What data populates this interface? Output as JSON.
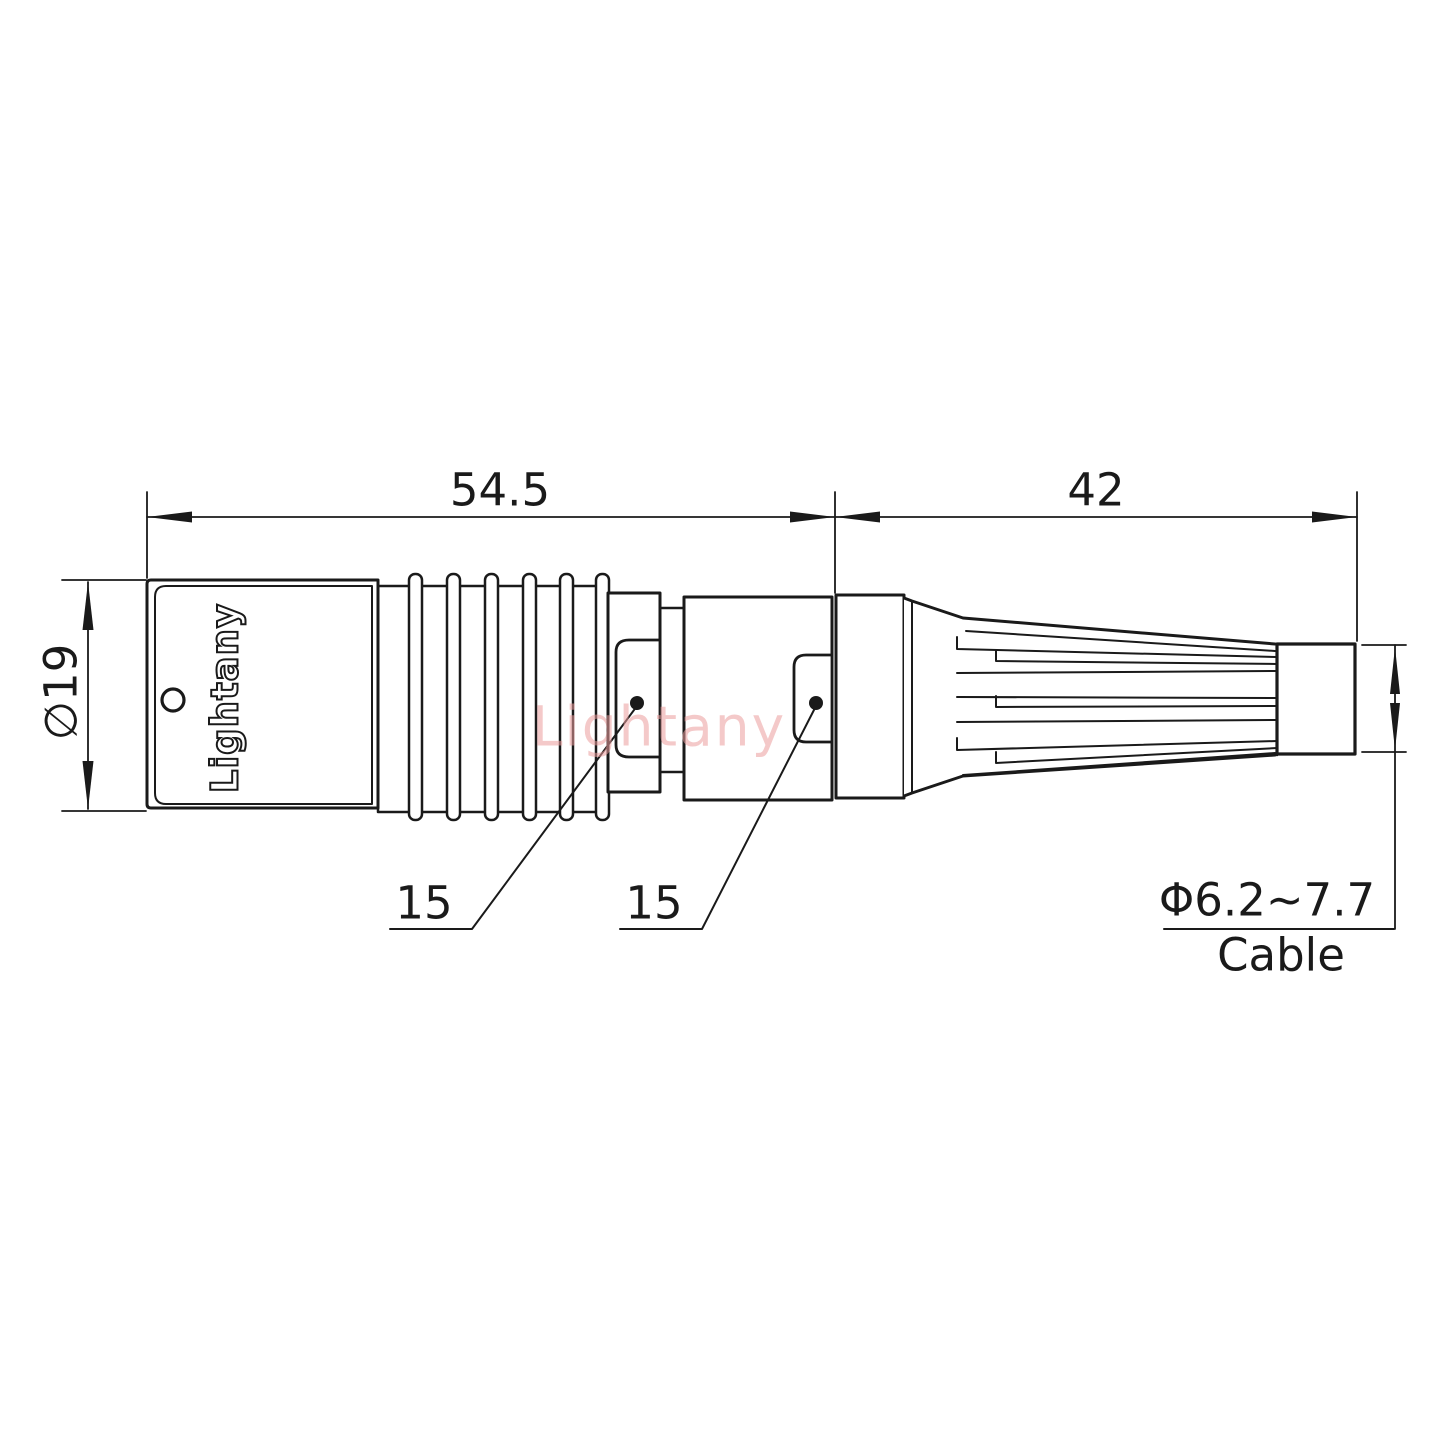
{
  "drawing": {
    "dimensions": {
      "front_section_length": "54.5",
      "rear_section_length": "42",
      "body_diameter": "∅19",
      "keyway_front": "15",
      "keyway_rear": "15",
      "cable_diameter_range": "Φ6.2~7.7",
      "cable_label": "Cable"
    },
    "branding": {
      "body_label": "Lightany",
      "watermark": "Lightany"
    },
    "colors": {
      "line": "#1a1a1a",
      "watermark_pink": "#ec9e9e",
      "background": "#ffffff"
    }
  }
}
